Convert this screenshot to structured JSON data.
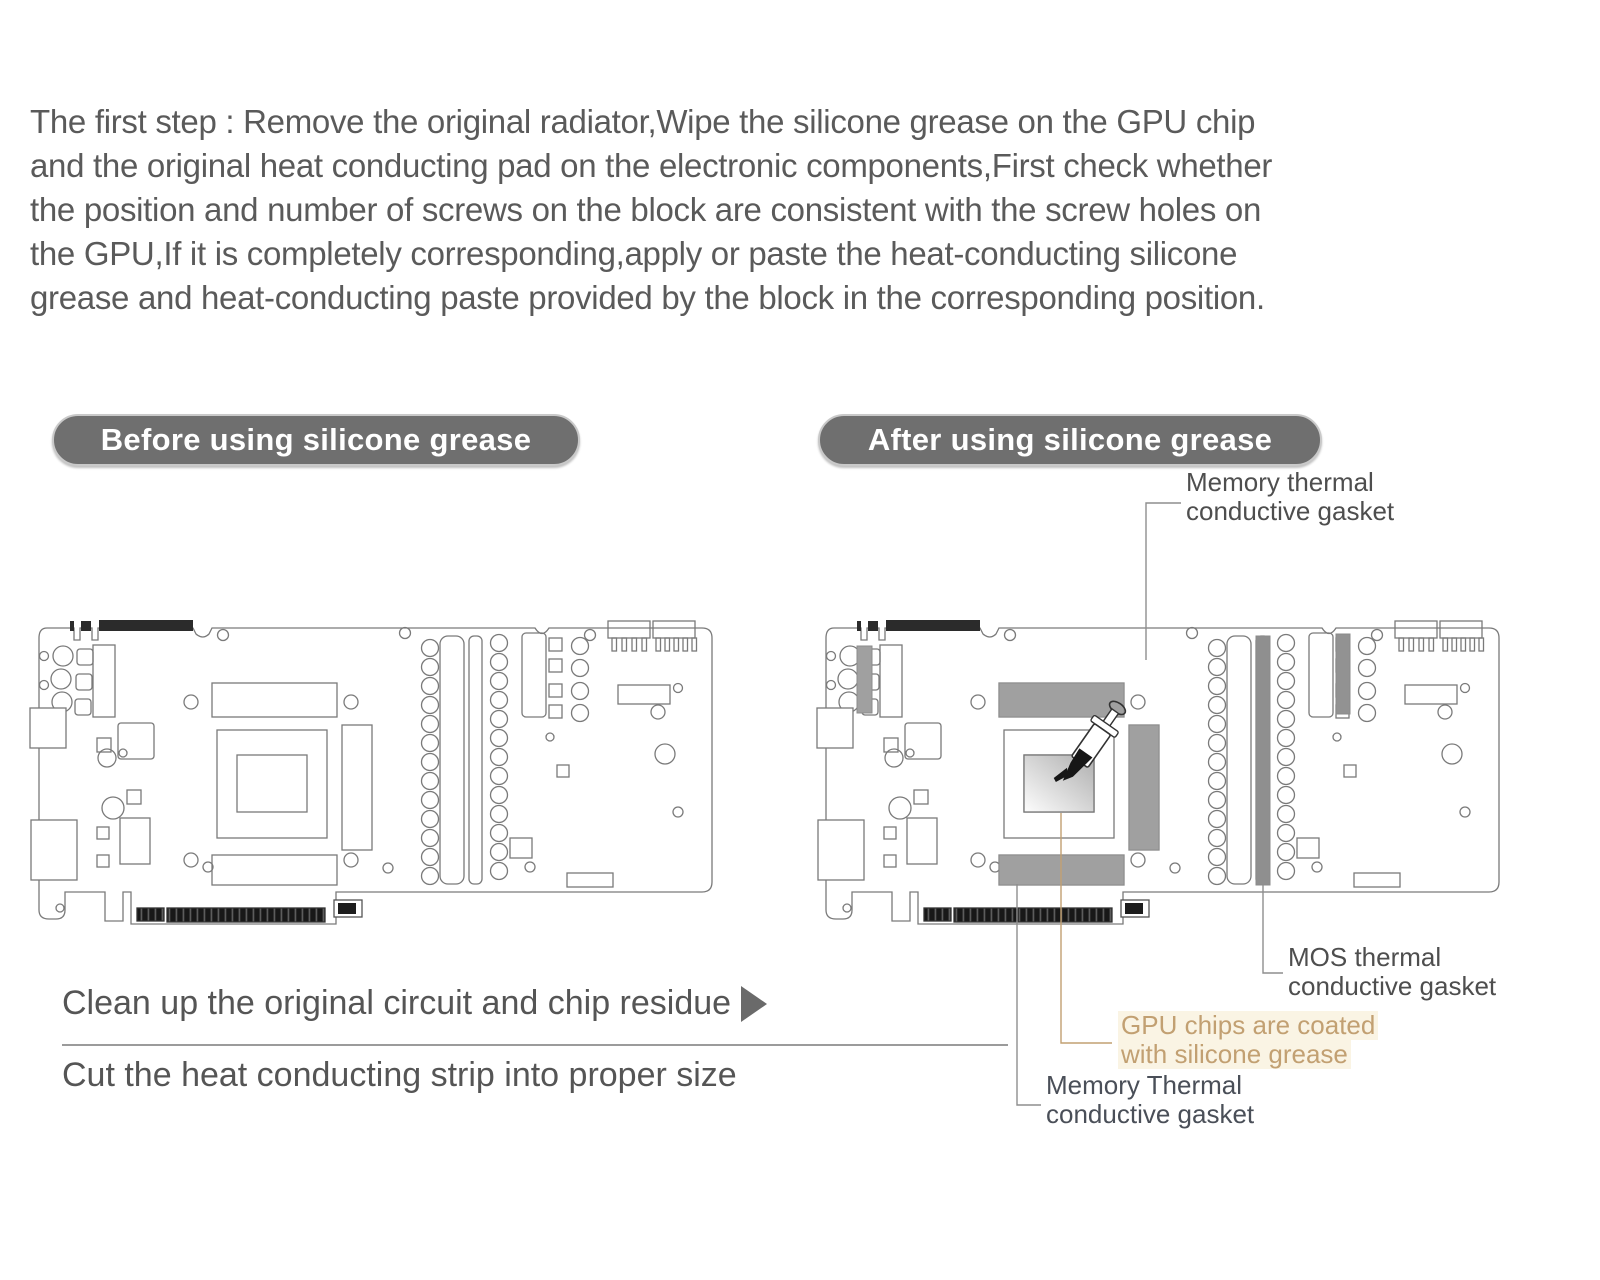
{
  "intro": {
    "lines": [
      "The first step : Remove the original radiator,Wipe the silicone grease on the GPU chip",
      "and the original heat conducting pad on the electronic components,First check whether",
      "the position and number of screws on the block are consistent with the screw holes on",
      "the GPU,If it is completely corresponding,apply or paste the heat-conducting silicone",
      "grease and heat-conducting paste provided by the block in the corresponding position."
    ]
  },
  "sections": {
    "before": {
      "label": "Before using silicone grease"
    },
    "after": {
      "label": "After using silicone grease"
    }
  },
  "annotations": {
    "memory_top": {
      "line1": "Memory thermal",
      "line2": "conductive gasket"
    },
    "mos": {
      "line1": "MOS thermal",
      "line2": "conductive gasket"
    },
    "gpu": {
      "line1": "GPU chips are coated",
      "line2": "with silicone grease"
    },
    "memory_bottom": {
      "line1": "Memory Thermal",
      "line2": "conductive gasket"
    }
  },
  "footer": {
    "line1": "Clean up the original circuit and chip residue",
    "line2": "Cut the heat conducting strip into proper size"
  },
  "icons": {
    "arrow": "play-arrow-icon",
    "syringe": "syringe-icon"
  },
  "colors": {
    "pill_background": "#6f6f6f",
    "body_text": "#5a5a5a",
    "annotation_text": "#4e4e4e",
    "accent_tan": "#c2a072",
    "thermal_pad_gray": "#a0a0a0",
    "line_art_gray": "#7a7a7a"
  }
}
